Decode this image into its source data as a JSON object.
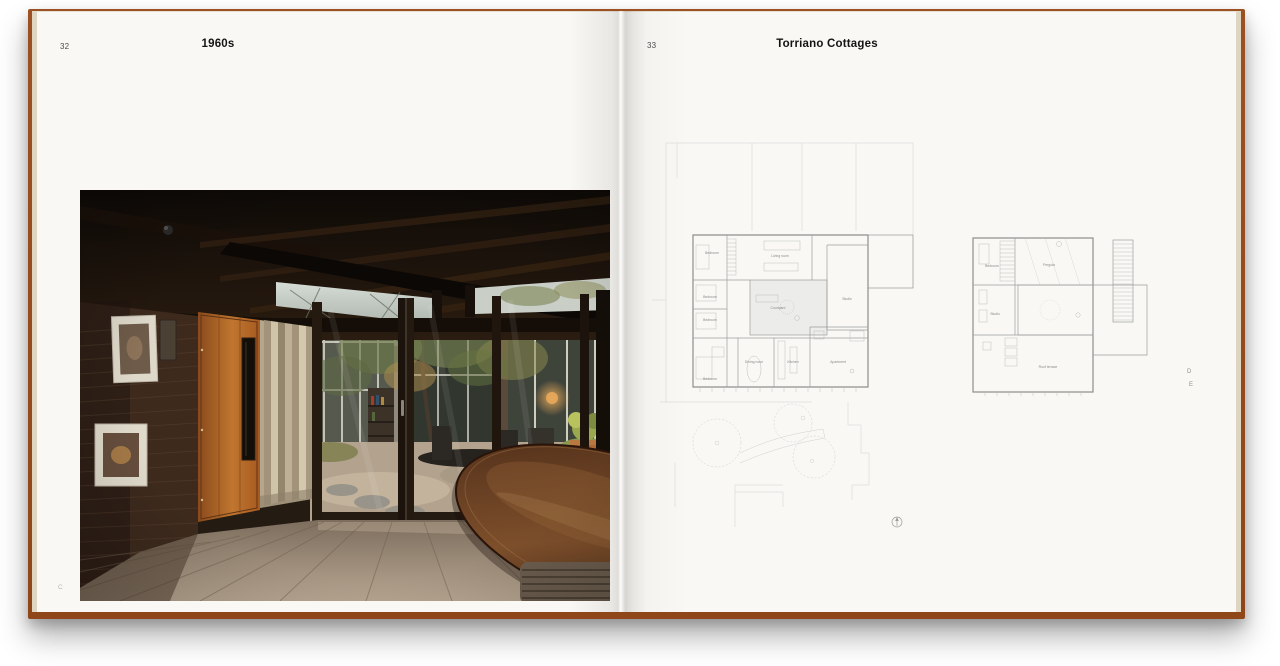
{
  "left_page": {
    "page_number": "32",
    "title": "1960s",
    "footer_mark": "C"
  },
  "right_page": {
    "page_number": "33",
    "title": "Torriano Cottages",
    "edge_marks": {
      "top": "D",
      "bottom": "E"
    },
    "ground_floor": {
      "rooms": {
        "bedroom_nw": "Bedroom",
        "living_room": "Living room",
        "bedroom_w1": "Bedroom",
        "bedroom_w2": "Bedroom",
        "courtyard": "Courtyard",
        "studio": "Studio",
        "bedroom_sw": "Bedroom",
        "dining_room": "Dining room",
        "kitchen": "Kitchen",
        "apartment": "Apartment"
      }
    },
    "first_floor": {
      "rooms": {
        "bedroom": "Bedroom",
        "pergola": "Pergola",
        "studio": "Studio",
        "roof_terrace": "Roof terrace"
      }
    }
  },
  "colors": {
    "cover": "#9c5122",
    "page": "#f9f8f5",
    "plan_line": "#9c9c9c",
    "title_text": "#141414"
  }
}
